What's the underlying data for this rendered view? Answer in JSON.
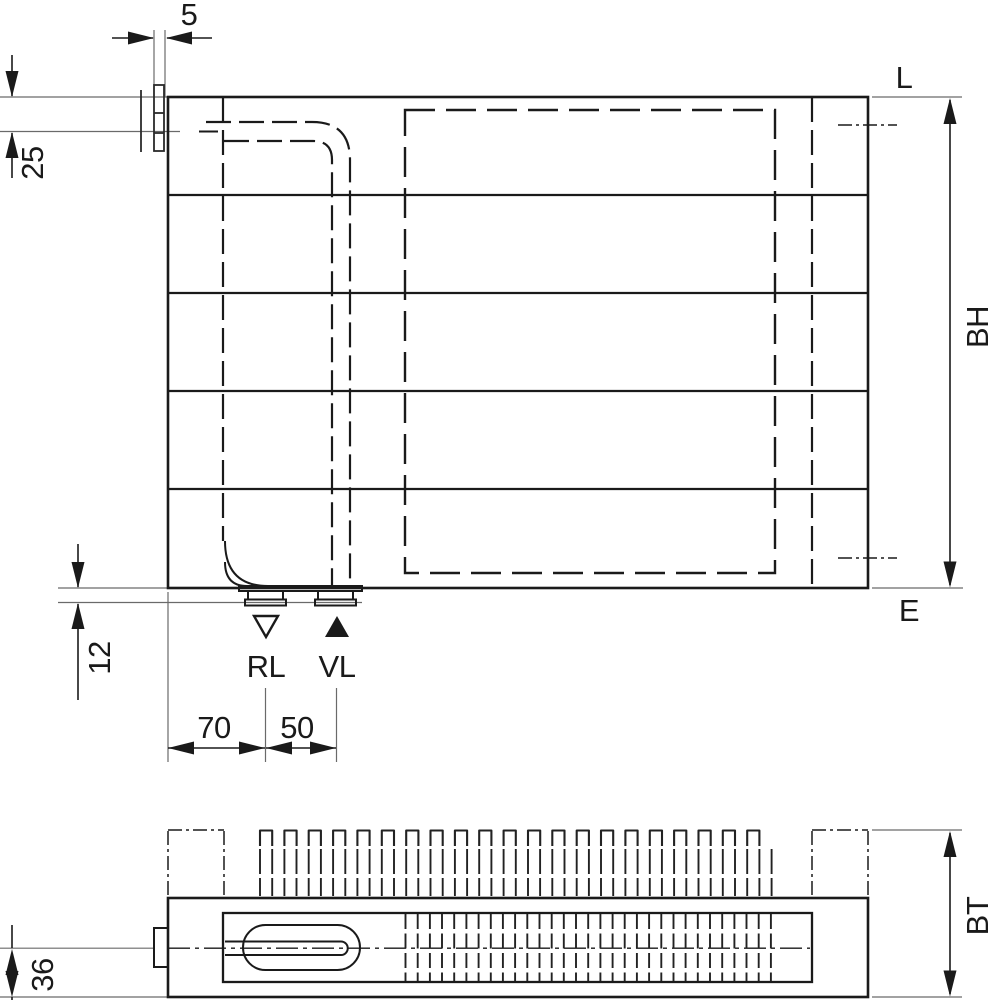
{
  "drawing": {
    "background": "#ffffff",
    "line_color": "#1a1a1a",
    "extension_line_color": "#6a6a6a"
  },
  "front_view": {
    "dim_bracket_thickness": "5",
    "dim_top_to_supply_center": "25",
    "dim_bottom_to_nozzle": "12",
    "dim_left_to_return": "70",
    "dim_return_to_supply": "50",
    "label_top_level": "L",
    "label_bottom_level": "E",
    "dim_height": "BH",
    "return_label": "RL",
    "supply_label": "VL"
  },
  "top_view": {
    "dim_depth": "BT",
    "dim_center_to_front": "36"
  }
}
